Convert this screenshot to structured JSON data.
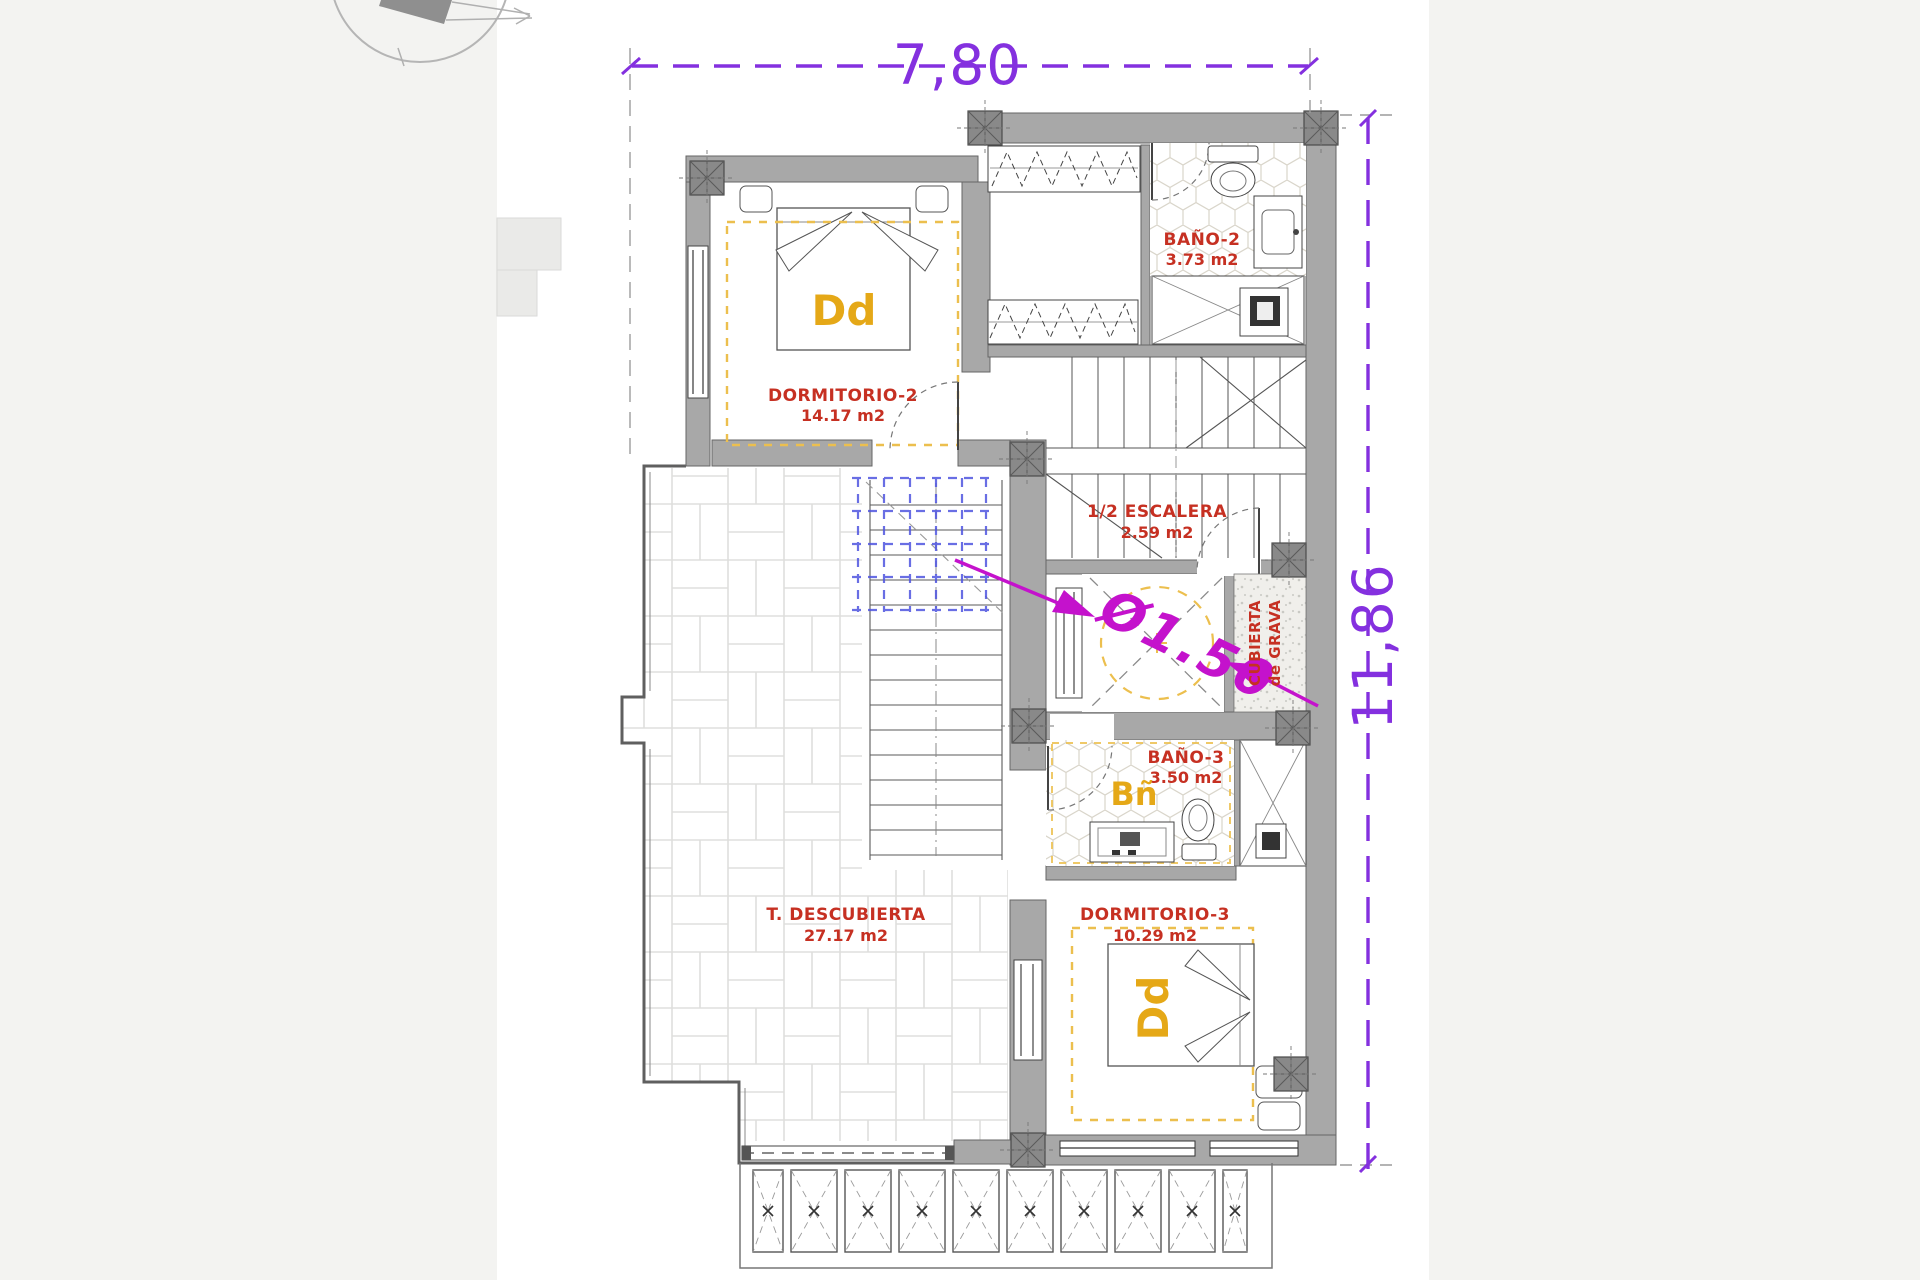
{
  "plan": {
    "type": "floor-plan",
    "floor": "upper"
  },
  "dimensions": {
    "top": "7,80",
    "right": "11,86"
  },
  "annotations": {
    "skylight_diameter": "Ø1.50",
    "roof_line1": "CUBIERTA",
    "roof_line2": "de GRAVA"
  },
  "rooms": {
    "dormitorio2": {
      "name": "DORMITORIO-2",
      "area": "14.17 m2",
      "code": "Dd"
    },
    "bano2": {
      "name": "BAÑO-2",
      "area": "3.73 m2"
    },
    "escalera": {
      "name": "1/2 ESCALERA",
      "area": "2.59 m2"
    },
    "bano3": {
      "name": "BAÑO-3",
      "area": "3.50 m2",
      "code": "Bñ"
    },
    "dormitorio3": {
      "name": "DORMITORIO-3",
      "area": "10.29 m2",
      "code": "Dd"
    },
    "terraza": {
      "name": "T. DESCUBIERTA",
      "area": "27.17 m2"
    }
  },
  "colors": {
    "dimension": "#8430df",
    "annotation": "#c412cc",
    "room_label": "#c63022",
    "room_code": "#e5a817",
    "wall": "#a8a8a8",
    "pier": "#898989",
    "accent_dash": "#ecbf4e",
    "blue_dash": "#5055e0"
  }
}
